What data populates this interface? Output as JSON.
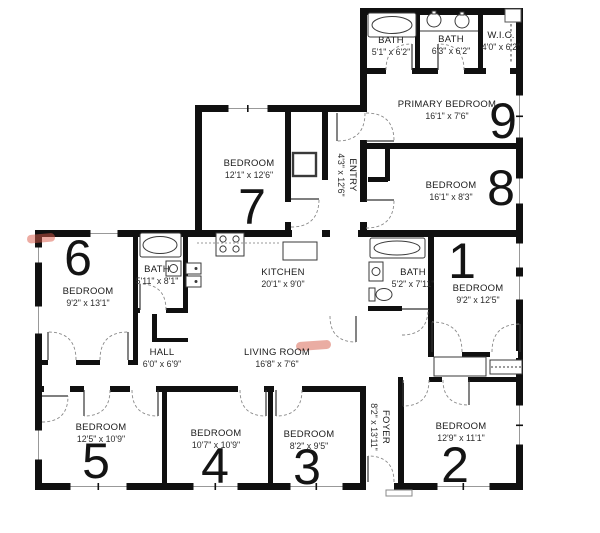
{
  "rooms": {
    "bath_a": {
      "name": "BATH",
      "dims": "5'1\" x 6'2\""
    },
    "bath_b": {
      "name": "BATH",
      "dims": "6'3\" x 6'2\""
    },
    "wic": {
      "name": "W.I.C.",
      "dims": "4'0\" x 6'2\""
    },
    "primary_bedroom": {
      "name": "PRIMARY BEDROOM",
      "dims": "16'1\" x 7'6\"",
      "number": "9"
    },
    "bedroom_8": {
      "name": "BEDROOM",
      "dims": "16'1\" x 8'3\"",
      "number": "8"
    },
    "bedroom_7": {
      "name": "BEDROOM",
      "dims": "12'1\" x 12'6\"",
      "number": "7"
    },
    "entry": {
      "name": "ENTRY",
      "dims": "4'3\" x 12'6\""
    },
    "kitchen": {
      "name": "KITCHEN",
      "dims": "20'1\" x 9'0\""
    },
    "bath_left": {
      "name": "BATH",
      "dims": "5'11\" x 8'1\""
    },
    "bedroom_6": {
      "name": "BEDROOM",
      "dims": "9'2\" x 13'1\"",
      "number": "6"
    },
    "bath_right": {
      "name": "BATH",
      "dims": "5'2\" x 7'11\""
    },
    "bedroom_1": {
      "name": "BEDROOM",
      "dims": "9'2\" x 12'5\"",
      "number": "1"
    },
    "hall": {
      "name": "HALL",
      "dims": "6'0\" x 6'9\""
    },
    "living_room": {
      "name": "LIVING ROOM",
      "dims": "16'8\" x 7'6\""
    },
    "foyer": {
      "name": "FOYER",
      "dims": "8'2\" x 13'11\""
    },
    "bedroom_5": {
      "name": "BEDROOM",
      "dims": "12'5\" x 10'9\"",
      "number": "5"
    },
    "bedroom_4": {
      "name": "BEDROOM",
      "dims": "10'7\" x 10'9\"",
      "number": "4"
    },
    "bedroom_3": {
      "name": "BEDROOM",
      "dims": "8'2\" x 9'5\"",
      "number": "3"
    },
    "bedroom_2": {
      "name": "BEDROOM",
      "dims": "12'9\" x 11'1\"",
      "number": "2"
    }
  },
  "colors": {
    "wall": "#101010",
    "linework": "#3a3a3a",
    "highlight_left_wall": "#dc5948",
    "highlight_living_room": "#d96a58",
    "background": "#ffffff"
  }
}
